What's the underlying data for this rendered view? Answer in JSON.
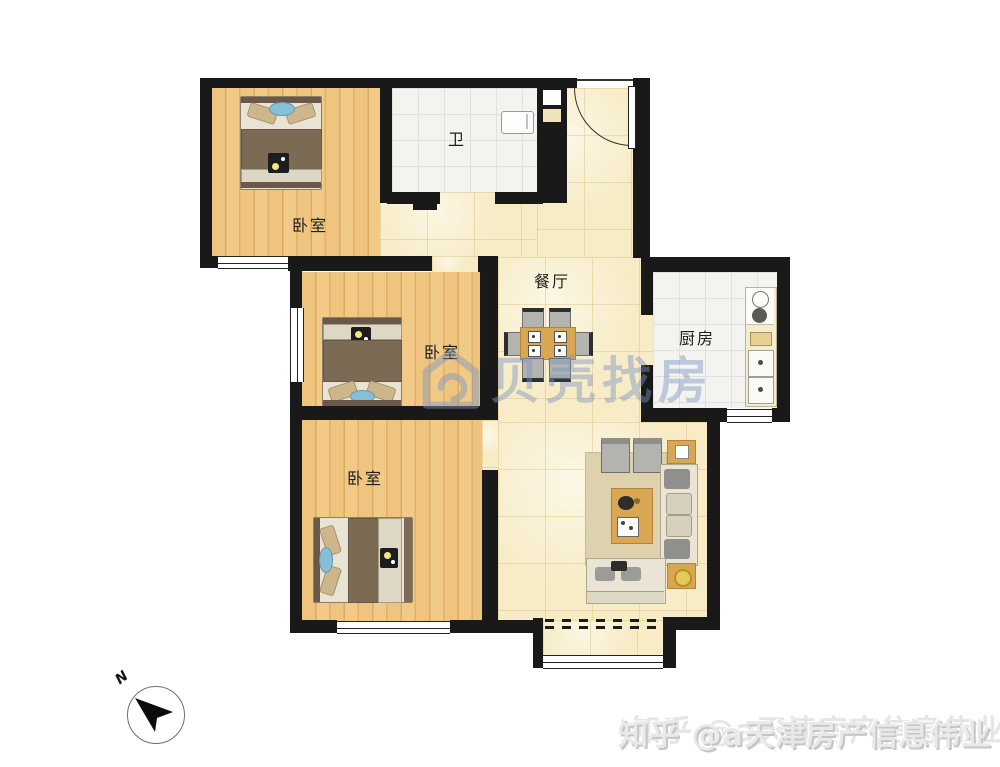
{
  "rooms": {
    "bedroom_top": {
      "label": "卧室"
    },
    "bedroom_mid": {
      "label": "卧室"
    },
    "bedroom_bottom": {
      "label": "卧室"
    },
    "bathroom": {
      "label": "卫"
    },
    "dining": {
      "label": "餐厅"
    },
    "kitchen": {
      "label": "厨房"
    }
  },
  "watermarks": {
    "beike_brand": "贝壳找房",
    "zhihu_credit": "知乎 @a天津房产信息伟业"
  },
  "compass": {
    "north_label": "N"
  },
  "colors": {
    "wall": "#191919",
    "wood_floor": "#ecc07c",
    "hall_floor": "#f7ecc6",
    "tile_floor": "#f3f3f0",
    "accent_furniture": "#d9a751",
    "watermark_blue": "rgba(123,148,196,0.45)"
  }
}
